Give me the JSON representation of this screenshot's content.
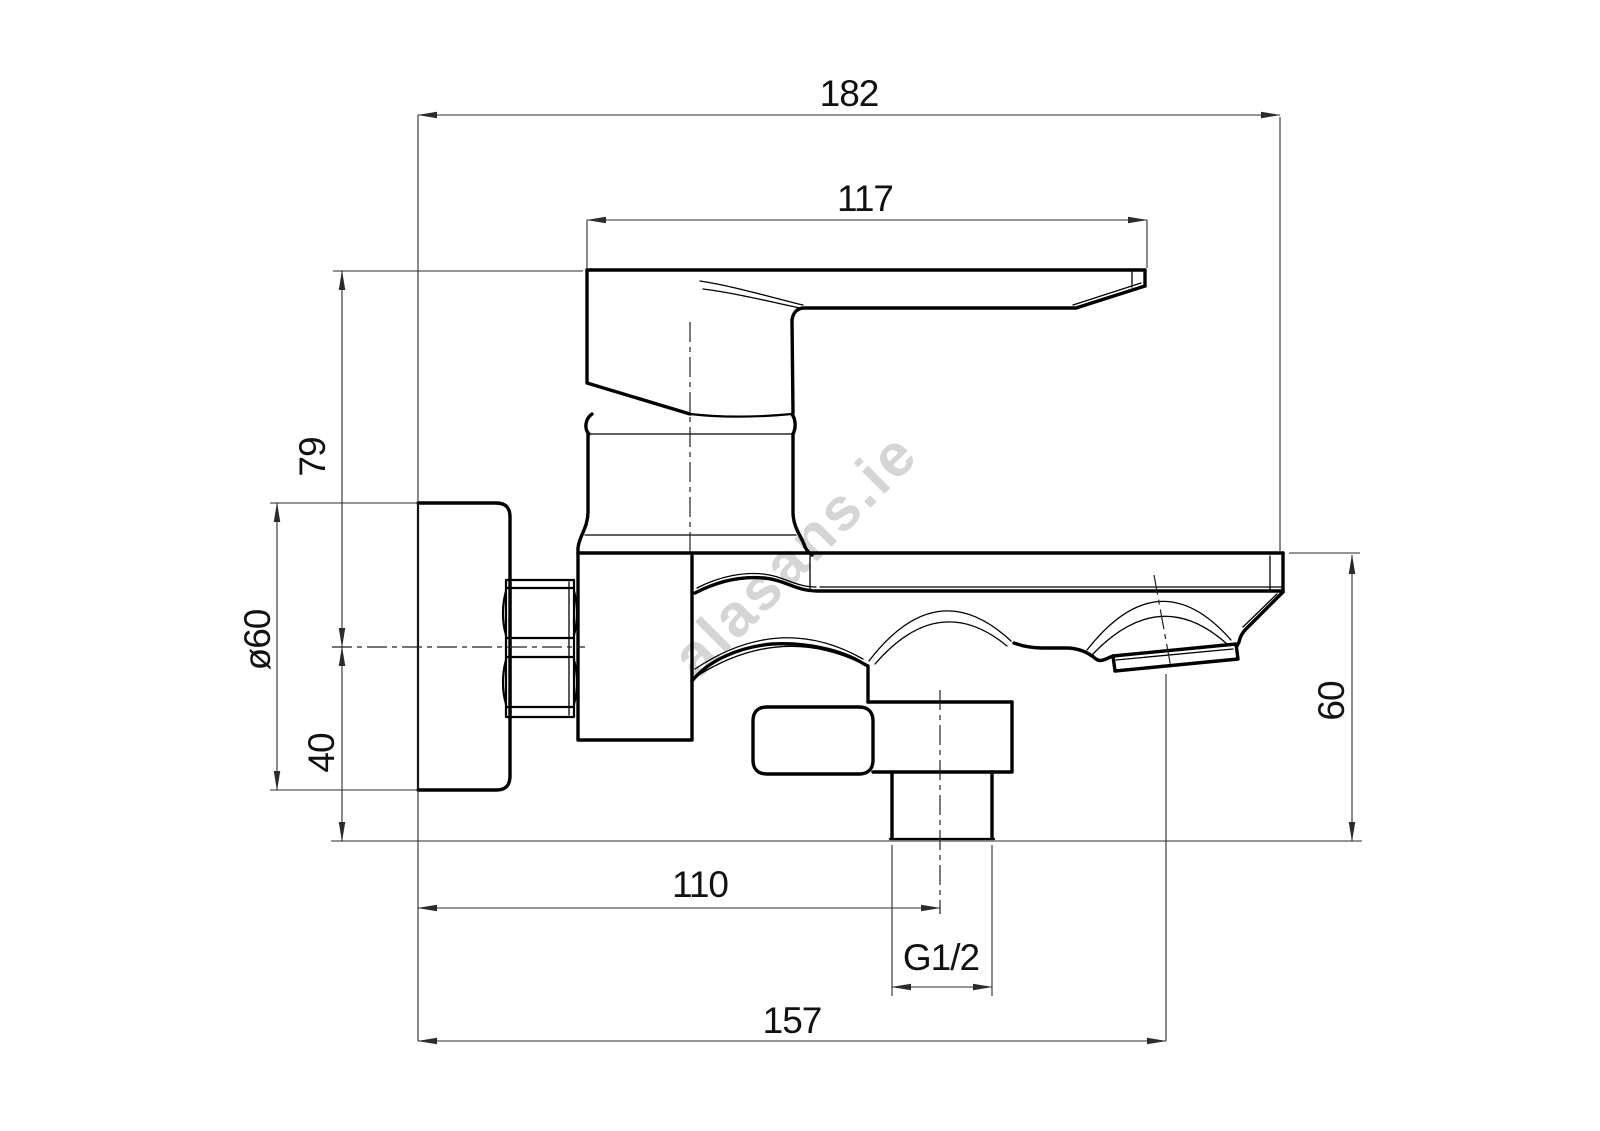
{
  "drawing": {
    "dimensions": {
      "overall_depth": "182",
      "lever_length": "117",
      "lever_top_to_axis": "79",
      "escutcheon_diameter": "ø60",
      "axis_to_outlet_plane": "40",
      "spout_drop": "60",
      "wall_to_diverter_axis": "110",
      "diverter_outlet_thread": "G1/2",
      "wall_to_spout_outlet": "157"
    },
    "watermark": {
      "text": "alasans.ie",
      "color": "#cbcbcb"
    },
    "colors": {
      "background": "#ffffff",
      "outline": "#000000",
      "dimension_lines": "#2b2b2b",
      "text": "#111111"
    }
  }
}
